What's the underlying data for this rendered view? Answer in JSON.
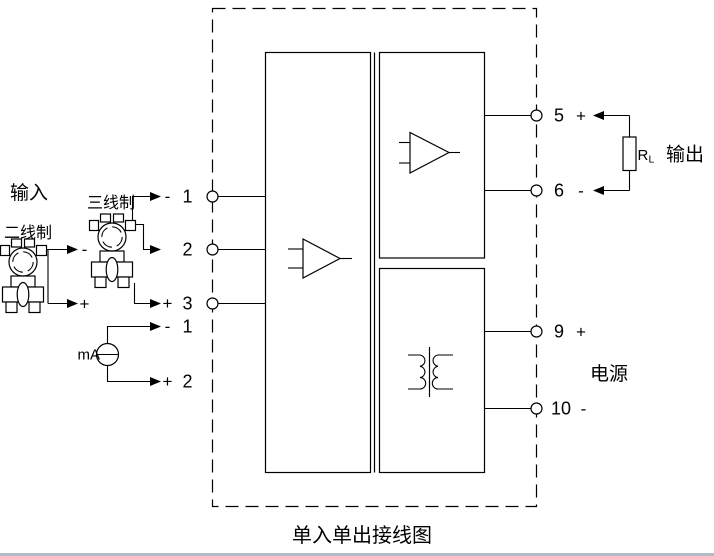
{
  "title": "单入单出接线图",
  "labels": {
    "input": "输入",
    "two_wire": "二线制",
    "three_wire": "三线制",
    "ma": "mA",
    "output": "输出",
    "power": "电源"
  },
  "load": {
    "name": "R",
    "sub": "L"
  },
  "left_terminals": [
    {
      "number": "1",
      "sign": "-"
    },
    {
      "number": "2",
      "sign": ""
    },
    {
      "number": "3",
      "sign": "+"
    }
  ],
  "two_wire_signs": {
    "minus": "-",
    "plus": "+"
  },
  "ma_terminals": [
    {
      "number": "1",
      "sign": "-"
    },
    {
      "number": "2",
      "sign": "+"
    }
  ],
  "right_terminals": [
    {
      "number": "5",
      "sign": "+"
    },
    {
      "number": "6",
      "sign": "-"
    },
    {
      "number": "9",
      "sign": "+"
    },
    {
      "number": "10",
      "sign": "-"
    }
  ],
  "colors": {
    "line": "#000000",
    "background": "#ffffff",
    "bottom_rule": "#b3bcc6"
  }
}
